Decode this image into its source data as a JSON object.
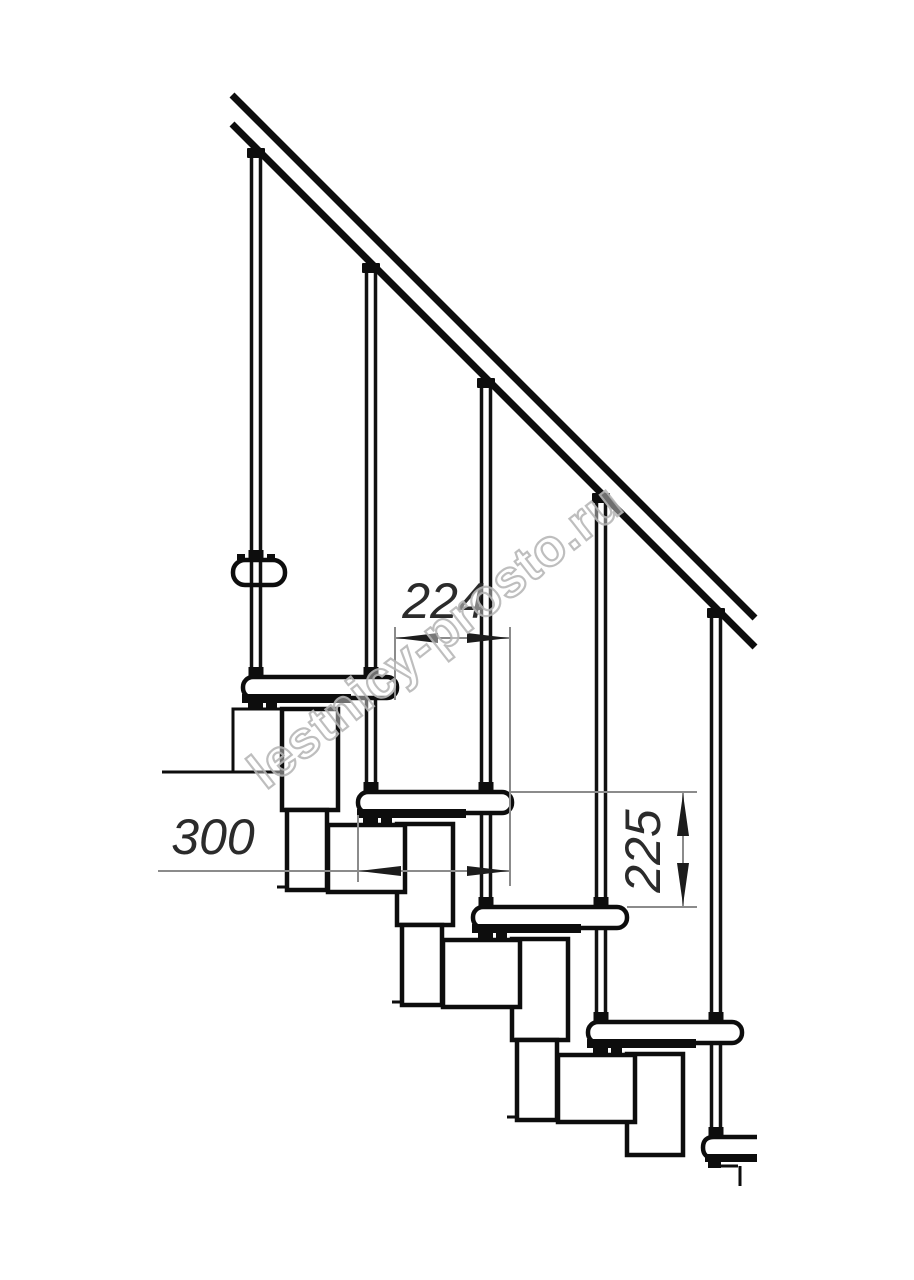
{
  "drawing": {
    "type": "staircase-side-view-technical-drawing",
    "dimensions": {
      "step_pitch_top": "224",
      "tread_depth_left": "300",
      "riser_height_right": "225"
    },
    "watermark": {
      "text": "lestnicy-prosto.ru"
    },
    "colors": {
      "line": "#0d0d0d",
      "dim_line": "#8b8b8b",
      "dim_text": "#2b2b2b",
      "watermark_outline": "#b8b8b8",
      "background": "#ffffff"
    }
  }
}
